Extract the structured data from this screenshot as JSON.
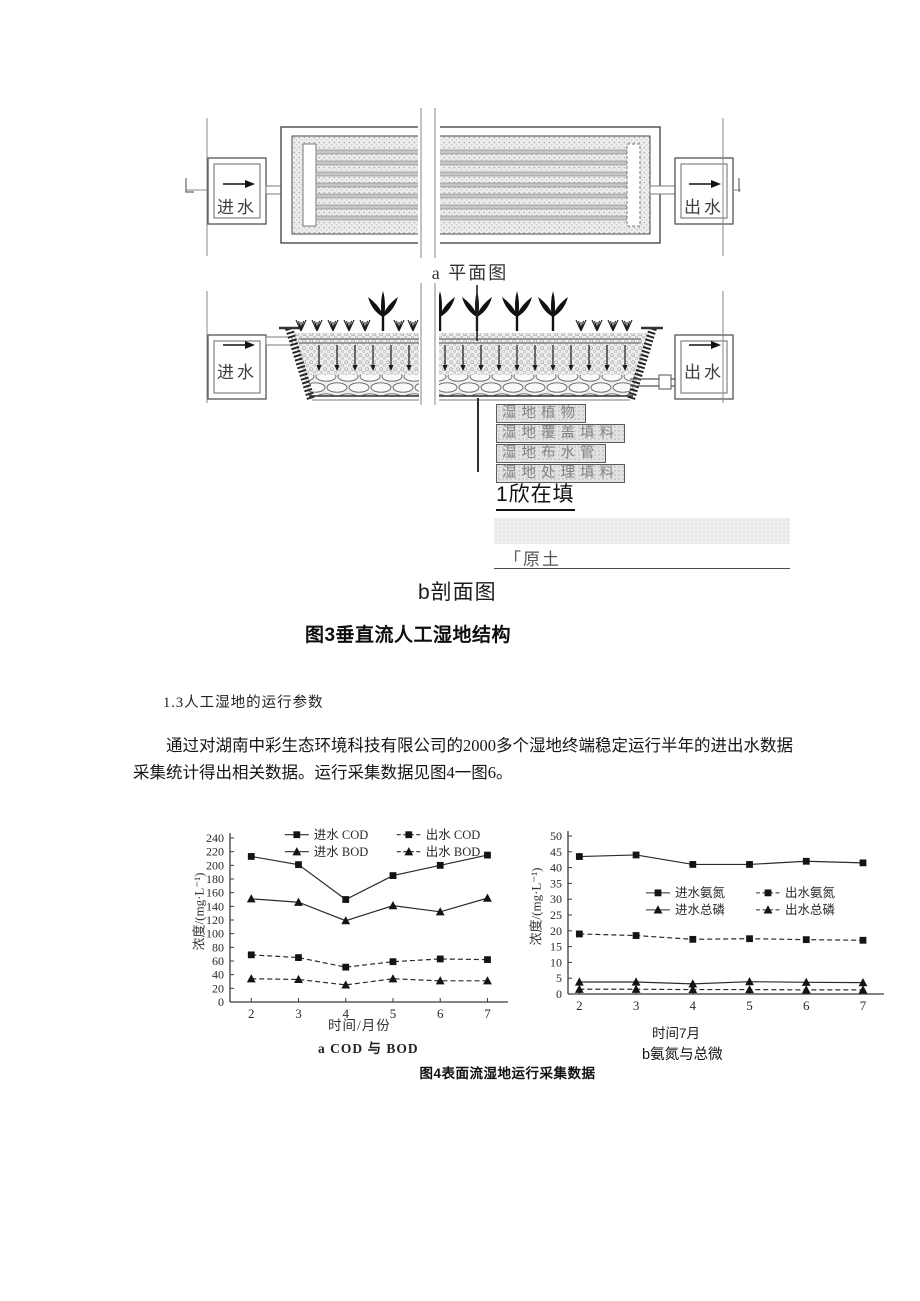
{
  "figure3": {
    "plan": {
      "inlet_label": "进水",
      "outlet_label": "出水",
      "caption": "a 平面图"
    },
    "section": {
      "inlet_label": "进水",
      "outlet_label": "出水",
      "layer_labels": [
        "湿地植物",
        "湿地覆盖填料",
        "湿地布水管",
        "湿地处理填料"
      ],
      "bed_label": "1欣在填",
      "soil_label": "「原土",
      "caption": "b剖面图"
    },
    "title": "图3垂直流人工湿地结构"
  },
  "body_text": {
    "section_heading": "1.3人工湿地的运行参数",
    "paragraph": "通过对湖南中彩生态环境科技有限公司的2000多个湿地终端稳定运行半年的进出水数据采集统计得出相关数据。运行采集数据见图4一图6。"
  },
  "figure4": {
    "caption": "图4表面流湿地运行采集数据"
  },
  "chart_data": [
    {
      "id": "chart0",
      "type": "line",
      "title": "a COD 与 BOD",
      "x": [
        2,
        3,
        4,
        5,
        6,
        7
      ],
      "xlim": [
        1.55,
        7.35
      ],
      "ylim": [
        0,
        240
      ],
      "ytick_step": 20,
      "xlabel": "时间/月份",
      "ylabel": "浓度/(mg·L⁻¹)",
      "sublabel": "a COD 与 BOD",
      "grid": false,
      "legend": {
        "fx": 0.2,
        "fy": -0.02,
        "col_w": 112,
        "row_h": 17
      },
      "series": [
        {
          "name": "进水 COD",
          "marker": "square",
          "line": "solid",
          "values": [
            213,
            201,
            150,
            185,
            200,
            215
          ]
        },
        {
          "name": "出水 COD",
          "marker": "square",
          "line": "dashed",
          "values": [
            69,
            65,
            51,
            59,
            63,
            62
          ]
        },
        {
          "name": "进水 BOD",
          "marker": "triangle",
          "line": "solid",
          "values": [
            151,
            146,
            119,
            141,
            132,
            152
          ]
        },
        {
          "name": "出水 BOD",
          "marker": "triangle",
          "line": "dashed",
          "values": [
            34,
            33,
            25,
            34,
            31,
            31
          ]
        }
      ]
    },
    {
      "id": "chart1",
      "type": "line",
      "title": "b氨氮与总微",
      "x": [
        2,
        3,
        4,
        5,
        6,
        7
      ],
      "xlim": [
        1.8,
        7.3
      ],
      "ylim": [
        0,
        50
      ],
      "ytick_step": 5,
      "xlabel": "时间7月",
      "ylabel": "浓度/(mg·L⁻¹)",
      "sublabel": "b氨氮与总微",
      "grid": false,
      "legend": {
        "fx": 0.25,
        "fy": 0.36,
        "col_w": 110,
        "row_h": 17
      },
      "series": [
        {
          "name": "进水氨氮",
          "marker": "square",
          "line": "solid",
          "values": [
            43.5,
            44,
            41,
            41,
            42,
            41.5
          ]
        },
        {
          "name": "出水氨氮",
          "marker": "square",
          "line": "dashed",
          "values": [
            19,
            18.5,
            17.3,
            17.5,
            17.2,
            17
          ]
        },
        {
          "name": "进水总磷",
          "marker": "triangle",
          "line": "solid",
          "values": [
            3.8,
            3.8,
            3.2,
            3.9,
            3.7,
            3.6
          ]
        },
        {
          "name": "出水总磷",
          "marker": "triangle",
          "line": "dashed",
          "values": [
            1.5,
            1.5,
            1.4,
            1.4,
            1.3,
            1.3
          ]
        }
      ]
    }
  ],
  "colors": {
    "ink": "#1a1a1a",
    "axis": "#3a3a3a",
    "diagram_gray": "#777777"
  }
}
